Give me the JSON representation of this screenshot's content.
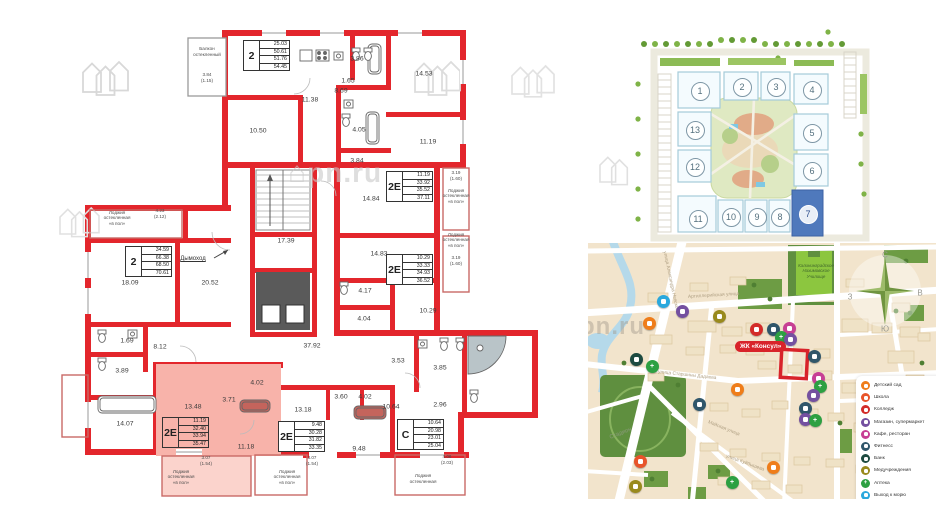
{
  "colors": {
    "wall_red": "#e3262c",
    "highlight_pink": "#f8b3aa",
    "highlight_pink_light": "#fbd3cc",
    "site_highlight_blue": "#4f79bc",
    "badge_red": "#d8232a",
    "map_bg": "#f2e4cc"
  },
  "floorplan": {
    "watermark": "pn.ru",
    "chimney_label": "Дымоход",
    "apartments": [
      {
        "type": "2",
        "values": [
          "25.03",
          "50.61",
          "51.76",
          "54.45"
        ],
        "x": 243,
        "y": 40,
        "highlighted": false
      },
      {
        "type": "2",
        "values": [
          "34.59",
          "66.38",
          "68.50",
          "70.61"
        ],
        "x": 125,
        "y": 246,
        "highlighted": false
      },
      {
        "type": "2Е",
        "values": [
          "11.19",
          "33.92",
          "35.52",
          "37.11"
        ],
        "x": 386,
        "y": 171,
        "highlighted": false
      },
      {
        "type": "2Е",
        "values": [
          "10.29",
          "33.33",
          "34.93",
          "36.52"
        ],
        "x": 386,
        "y": 254,
        "highlighted": false
      },
      {
        "type": "2Е",
        "values": [
          "11.19",
          "32.40",
          "33.94",
          "35.47"
        ],
        "x": 162,
        "y": 417,
        "highlighted": true
      },
      {
        "type": "2Е",
        "values": [
          "9.48",
          "30.28",
          "31.82",
          "33.35"
        ],
        "x": 278,
        "y": 421,
        "highlighted": false
      },
      {
        "type": "С",
        "values": [
          "10.64",
          "20.98",
          "23.01",
          "25.04"
        ],
        "x": 397,
        "y": 419,
        "highlighted": false
      }
    ],
    "room_labels": [
      {
        "t": "11.38",
        "x": 310,
        "y": 100
      },
      {
        "t": "10.50",
        "x": 258,
        "y": 131
      },
      {
        "t": "1.65",
        "x": 348,
        "y": 81
      },
      {
        "t": "3.86",
        "x": 357,
        "y": 59
      },
      {
        "t": "8.69",
        "x": 341,
        "y": 91
      },
      {
        "t": "14.53",
        "x": 424,
        "y": 74
      },
      {
        "t": "4.05",
        "x": 359,
        "y": 130
      },
      {
        "t": "11.19",
        "x": 428,
        "y": 142
      },
      {
        "t": "3.84",
        "x": 357,
        "y": 161
      },
      {
        "t": "14.84",
        "x": 371,
        "y": 199
      },
      {
        "t": "17.39",
        "x": 286,
        "y": 241
      },
      {
        "t": "14.83",
        "x": 379,
        "y": 254
      },
      {
        "t": "18.09",
        "x": 130,
        "y": 283
      },
      {
        "t": "20.52",
        "x": 210,
        "y": 283
      },
      {
        "t": "4.17",
        "x": 365,
        "y": 291
      },
      {
        "t": "4.04",
        "x": 364,
        "y": 319
      },
      {
        "t": "10.29",
        "x": 428,
        "y": 311
      },
      {
        "t": "37.92",
        "x": 312,
        "y": 346
      },
      {
        "t": "1.69",
        "x": 127,
        "y": 341
      },
      {
        "t": "8.12",
        "x": 160,
        "y": 347
      },
      {
        "t": "3.89",
        "x": 122,
        "y": 371
      },
      {
        "t": "3.53",
        "x": 398,
        "y": 361
      },
      {
        "t": "3.85",
        "x": 440,
        "y": 368
      },
      {
        "t": "14.07",
        "x": 125,
        "y": 424
      },
      {
        "t": "13.48",
        "x": 193,
        "y": 407
      },
      {
        "t": "3.71",
        "x": 229,
        "y": 400
      },
      {
        "t": "4.02",
        "x": 257,
        "y": 383
      },
      {
        "t": "11.18",
        "x": 246,
        "y": 447
      },
      {
        "t": "13.18",
        "x": 303,
        "y": 410
      },
      {
        "t": "3.60",
        "x": 341,
        "y": 397
      },
      {
        "t": "4.02",
        "x": 365,
        "y": 397
      },
      {
        "t": "9.48",
        "x": 359,
        "y": 449
      },
      {
        "t": "10.64",
        "x": 391,
        "y": 407
      },
      {
        "t": "2.96",
        "x": 440,
        "y": 405
      }
    ],
    "annotations": [
      {
        "lines": [
          "Балкон",
          "остекленный"
        ],
        "x": 207,
        "y": 52
      },
      {
        "lines": [
          "3.84",
          "(1.15)"
        ],
        "x": 207,
        "y": 78
      },
      {
        "lines": [
          "4.23",
          "(2.12)"
        ],
        "x": 160,
        "y": 214
      },
      {
        "lines": [
          "Лоджия",
          "остекленная",
          "«в пол»"
        ],
        "x": 117,
        "y": 218
      },
      {
        "lines": [
          "3.19",
          "(1.60)"
        ],
        "x": 456,
        "y": 176
      },
      {
        "lines": [
          "Лоджия",
          "остекленная",
          "«в пол»"
        ],
        "x": 456,
        "y": 196
      },
      {
        "lines": [
          "Лоджия",
          "остекленная",
          "«в пол»"
        ],
        "x": 456,
        "y": 240
      },
      {
        "lines": [
          "3.19",
          "(1.60)"
        ],
        "x": 456,
        "y": 261
      },
      {
        "lines": [
          "3.07",
          "(1.54)"
        ],
        "x": 206,
        "y": 461
      },
      {
        "lines": [
          "Лоджия",
          "остекленная",
          "«в пол»"
        ],
        "x": 181,
        "y": 477
      },
      {
        "lines": [
          "3.07",
          "(1.54)"
        ],
        "x": 312,
        "y": 461
      },
      {
        "lines": [
          "Лоджия",
          "остекленная",
          "«в пол»"
        ],
        "x": 287,
        "y": 477
      },
      {
        "lines": [
          "4.06",
          "(2.03)"
        ],
        "x": 447,
        "y": 460
      },
      {
        "lines": [
          "Лоджия",
          "остекленная"
        ],
        "x": 423,
        "y": 479
      }
    ]
  },
  "site_plan": {
    "buildings": [
      {
        "n": "1",
        "x": 101,
        "y": 76
      },
      {
        "n": "2",
        "x": 143,
        "y": 72
      },
      {
        "n": "3",
        "x": 177,
        "y": 72
      },
      {
        "n": "4",
        "x": 213,
        "y": 75
      },
      {
        "n": "13",
        "x": 96,
        "y": 115
      },
      {
        "n": "5",
        "x": 213,
        "y": 118
      },
      {
        "n": "12",
        "x": 96,
        "y": 152
      },
      {
        "n": "6",
        "x": 213,
        "y": 156
      },
      {
        "n": "11",
        "x": 99,
        "y": 204
      },
      {
        "n": "10",
        "x": 132,
        "y": 202
      },
      {
        "n": "9",
        "x": 158,
        "y": 202
      },
      {
        "n": "8",
        "x": 181,
        "y": 202
      },
      {
        "n": "7",
        "x": 209,
        "y": 199,
        "highlighted": true
      }
    ]
  },
  "map": {
    "complex_badge": "ЖК «Консул»",
    "watermark": "pn.ru",
    "college_lines": [
      "Калининградское",
      "Нахимовское",
      "Училище"
    ],
    "compass": {
      "n": "С",
      "e": "В",
      "s": "Ю",
      "w": "З"
    },
    "streets": [
      {
        "name": "Артиллерийская улица",
        "x": 100,
        "y": 52,
        "rot": -3.5
      },
      {
        "name": "улица Старшины Дадаева",
        "x": 70,
        "y": 127,
        "rot": 6
      },
      {
        "name": "Майская улица",
        "x": 120,
        "y": 177,
        "rot": 22
      },
      {
        "name": "улица Куйбышева",
        "x": 138,
        "y": 211,
        "rot": 20
      },
      {
        "name": "улица Александра Невского",
        "x": 76,
        "y": 6,
        "rot": 78
      },
      {
        "name": "Полевая улица",
        "x": 344,
        "y": 138,
        "rot": 85
      }
    ],
    "labels": [
      {
        "text": "Стадион",
        "x": 22,
        "y": 192,
        "rot": -22,
        "color": "#8a9a7a"
      }
    ],
    "legend": [
      {
        "label": "Детский сад",
        "color": "#ef7d1a",
        "type": "kindergarten"
      },
      {
        "label": "Школа",
        "color": "#e8542a",
        "type": "school"
      },
      {
        "label": "Колледж",
        "color": "#d32b28",
        "type": "college"
      },
      {
        "label": "Магазин, супермаркет",
        "color": "#7450a0",
        "type": "supermarket"
      },
      {
        "label": "Кафе, ресторан",
        "color": "#c73f94",
        "type": "cafe"
      },
      {
        "label": "Фитнесс",
        "color": "#30566a",
        "type": "fitness"
      },
      {
        "label": "Банк",
        "color": "#1d4a40",
        "type": "bank"
      },
      {
        "label": "Медучреждения",
        "color": "#998a1d",
        "type": "medical"
      },
      {
        "label": "Аптека",
        "color": "#2da042",
        "type": "pharmacy"
      },
      {
        "label": "Выход к морю",
        "color": "#2aa8dd",
        "type": "sea"
      }
    ],
    "pois": [
      {
        "type": "sea",
        "x": 75,
        "y": 58
      },
      {
        "type": "supermarket",
        "x": 94,
        "y": 68
      },
      {
        "type": "medical",
        "x": 131,
        "y": 73
      },
      {
        "type": "kindergarten",
        "x": 61,
        "y": 80
      },
      {
        "type": "college",
        "x": 168,
        "y": 86
      },
      {
        "type": "fitness",
        "x": 185,
        "y": 86
      },
      {
        "type": "cafe",
        "x": 201,
        "y": 85
      },
      {
        "type": "pharmacy",
        "x": 193,
        "y": 94
      },
      {
        "type": "supermarket",
        "x": 202,
        "y": 96
      },
      {
        "type": "fitness",
        "x": 226,
        "y": 113
      },
      {
        "type": "bank",
        "x": 48,
        "y": 116
      },
      {
        "type": "pharmacy",
        "x": 64,
        "y": 123
      },
      {
        "type": "cafe",
        "x": 230,
        "y": 135
      },
      {
        "type": "pharmacy",
        "x": 232,
        "y": 143
      },
      {
        "type": "kindergarten",
        "x": 149,
        "y": 146
      },
      {
        "type": "supermarket",
        "x": 225,
        "y": 152
      },
      {
        "type": "fitness",
        "x": 111,
        "y": 161
      },
      {
        "type": "fitness",
        "x": 217,
        "y": 165
      },
      {
        "type": "supermarket",
        "x": 217,
        "y": 176
      },
      {
        "type": "pharmacy",
        "x": 227,
        "y": 177
      },
      {
        "type": "school",
        "x": 52,
        "y": 218
      },
      {
        "type": "medical",
        "x": 47,
        "y": 243
      },
      {
        "type": "kindergarten",
        "x": 185,
        "y": 224
      },
      {
        "type": "pharmacy",
        "x": 144,
        "y": 239
      }
    ]
  }
}
